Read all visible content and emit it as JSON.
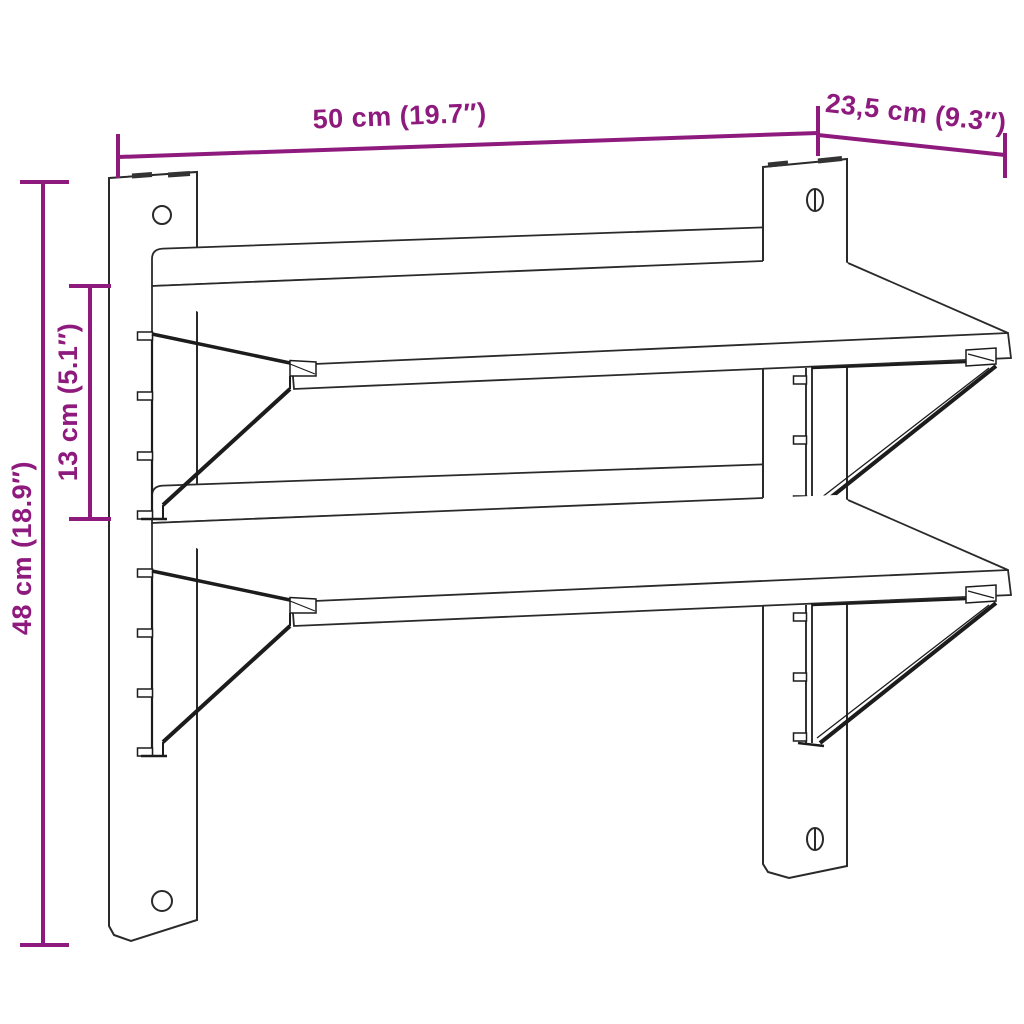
{
  "diagram": {
    "figure_type": "product-dimension-line-drawing",
    "subject": "two-tier-wall-mounted-shelf",
    "colors": {
      "background": "#ffffff",
      "outline": "#2a2a2a",
      "dimension": "#8E1A7E"
    },
    "dimensions": {
      "width": "50 cm (19.7″)",
      "depth": "23,5 cm (9.3″)",
      "height": "48 cm (18.9″)",
      "shelf_gap": "13 cm (5.1″)"
    }
  }
}
